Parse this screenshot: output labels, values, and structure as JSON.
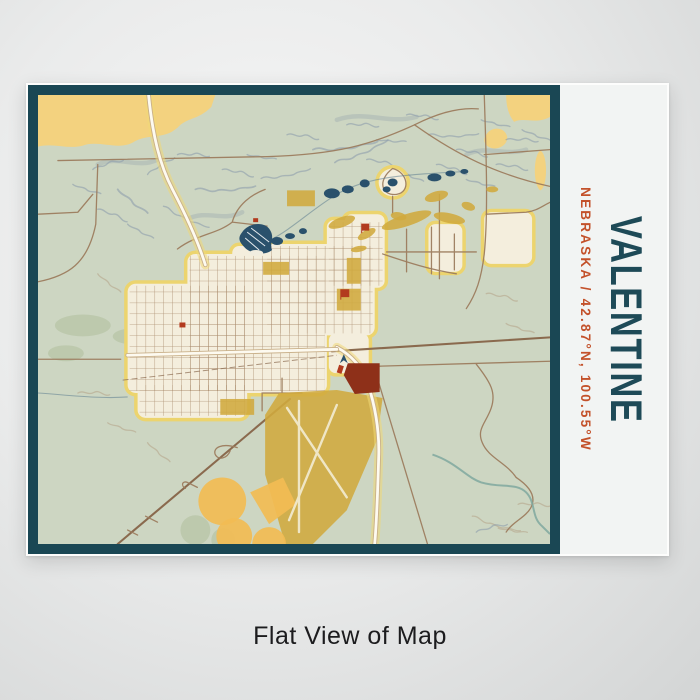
{
  "print": {
    "title": "VALENTINE",
    "subtitle": "NEBRASKA / 42.87°N, 100.55°W",
    "location_name": "Valentine",
    "region": "Nebraska",
    "coordinates": "42.87°N, 100.55°W"
  },
  "caption": {
    "label": "Flat View of Map"
  },
  "map": {
    "style": "vintage topographic street map",
    "features": [
      "city street grid of Valentine",
      "Lake Minnechaduza and pond chain northeast of town",
      "US highway running north to south",
      "airport runways southwest of town",
      "canyon contour terrain north of town",
      "river meander in southeast corner"
    ]
  },
  "colors": {
    "frame_teal": "#1a4754",
    "title_teal": "#1e4a57",
    "subtitle_orange": "#c3512a",
    "map_sage": "#cdd6c2",
    "sand_yellow": "#f3d27f",
    "urban_cream": "#f4eedd",
    "urban_halo": "#ecd46e",
    "road_brown": "#9c7c5e",
    "water_blue": "#2a516c",
    "terrain_blue": "#8fa0ac",
    "terrain_tan": "#b5a387",
    "olive": "#d0aa3e",
    "orange_accent": "#f2bc54",
    "maroon": "#8e3019",
    "landmark_red": "#b23a1e"
  }
}
